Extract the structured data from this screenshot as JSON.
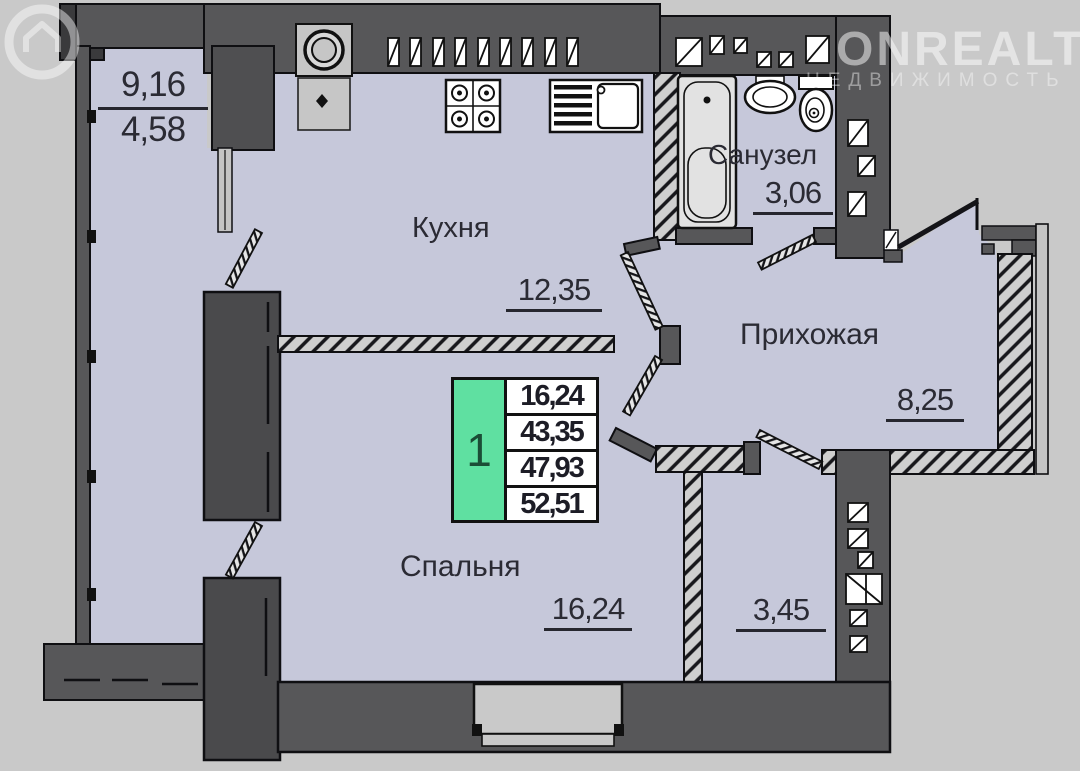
{
  "watermark": {
    "brand": "ONREALT",
    "tagline": "НЕДВИЖИМОСТЬ"
  },
  "rooms": {
    "balcony": {
      "area_top": "9,16",
      "area_bottom": "4,58"
    },
    "kitchen": {
      "name": "Кухня",
      "area": "12,35"
    },
    "bathroom": {
      "name": "Санузел",
      "area": "3,06"
    },
    "hallway": {
      "name": "Прихожая",
      "area": "8,25"
    },
    "bedroom": {
      "name": "Спальня",
      "area": "16,24"
    },
    "storage": {
      "area": "3,45"
    }
  },
  "legend": {
    "unit_number": "1",
    "rows": [
      "16,24",
      "43,35",
      "47,93",
      "52,51"
    ]
  },
  "colors": {
    "background": "#c9c9c9",
    "room_fill": "#c6c8da",
    "wall": "#575759",
    "outline": "#0f0f12",
    "legend_green": "#5fe0a1",
    "text": "#2b2b34",
    "watermark": "rgba(255,255,255,0.5)"
  }
}
